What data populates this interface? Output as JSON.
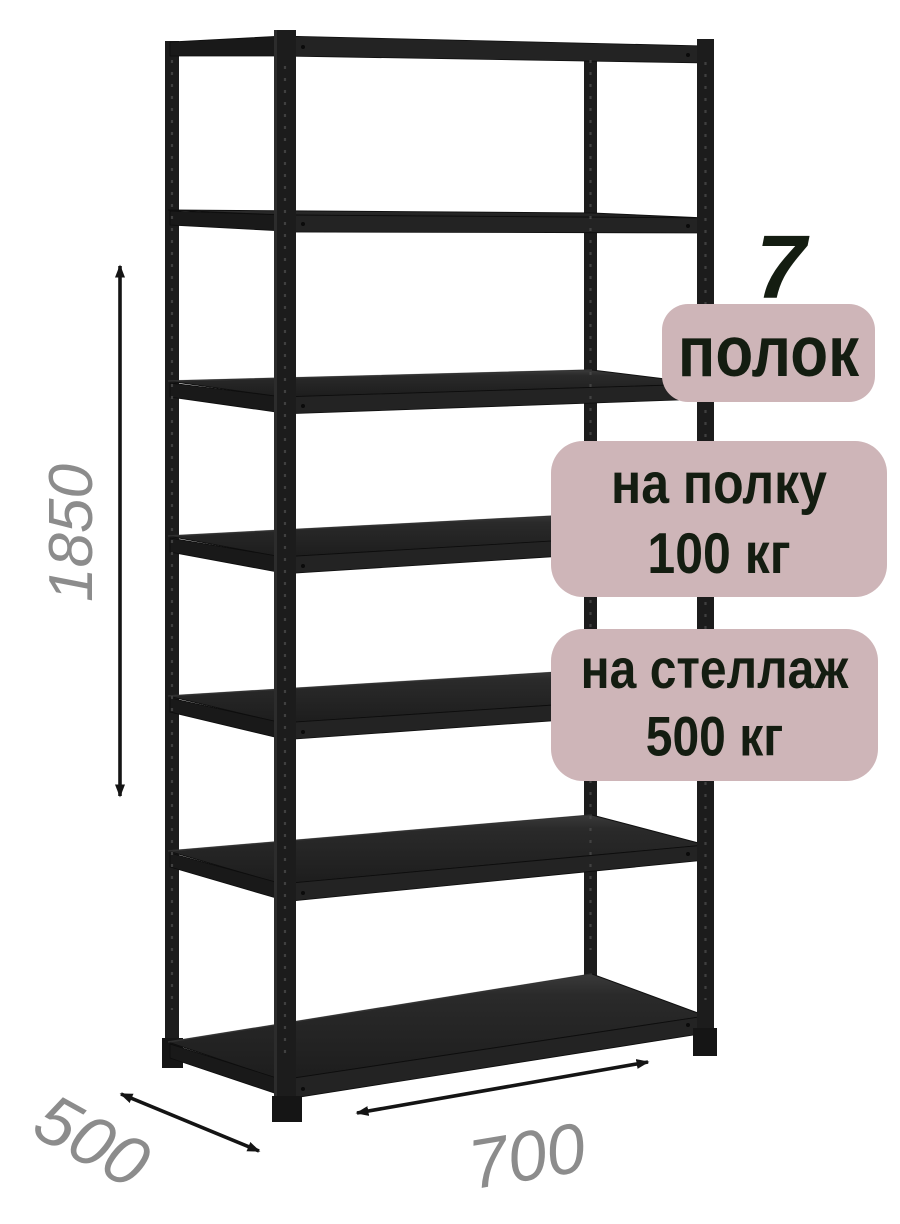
{
  "badges": {
    "shelf_count_value": "7",
    "shelf_count_label": "полок",
    "per_shelf": {
      "line1": "на полку",
      "line2": "100 кг"
    },
    "per_rack": {
      "line1": "на стеллаж",
      "line2": "500 кг"
    }
  },
  "dimensions": {
    "height_mm": "1850",
    "depth_mm": "500",
    "width_mm": "700"
  },
  "rack": {
    "shelves": 7,
    "description_color": "#202020"
  },
  "colors": {
    "background": "#ffffff",
    "badge_bg": "#ceb5b8",
    "badge_text": "#141d11",
    "dimension_text": "#8c8c8c",
    "arrow": "#141414",
    "metal": "#202020"
  }
}
